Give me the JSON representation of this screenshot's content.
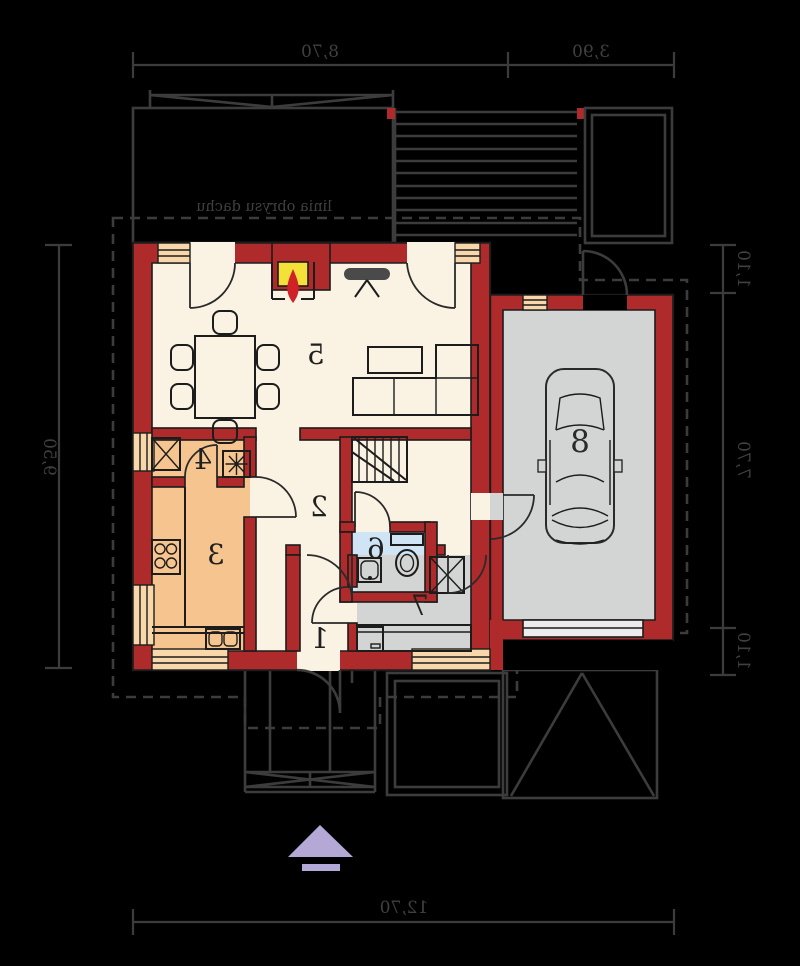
{
  "title": "Parter - rzut kondygnacji (plan lustrzany)",
  "labels": {
    "roof_outline": "linia obrysu dachu"
  },
  "dimensions": {
    "top_segments": [
      "8,70",
      "3,90"
    ],
    "left_side": "9,50",
    "right_segments": [
      "1,10",
      "7,70",
      "1,10"
    ],
    "bottom": "12,70"
  },
  "rooms": {
    "entry": "1",
    "hall": "2",
    "kitchen": "3",
    "pantry": "4",
    "living": "5",
    "bathroom": "6",
    "utility": "7",
    "garage": "8"
  },
  "colors": {
    "background": "#000000",
    "wall": "#ae2a2b",
    "floor_main": "#faf2e2",
    "floor_kitchen": "#f6c48e",
    "floor_bath": "#cfe4f4",
    "floor_garage": "#d3d5d4",
    "window": "#f8d8ab",
    "fire_box": "#f3e13a",
    "flame": "#cf2127",
    "north_arrow": "#b3a8d6",
    "line_exterior": "#3c3c3c",
    "line_interior": "#1c1c1c",
    "tv": "#4a4a4a"
  }
}
